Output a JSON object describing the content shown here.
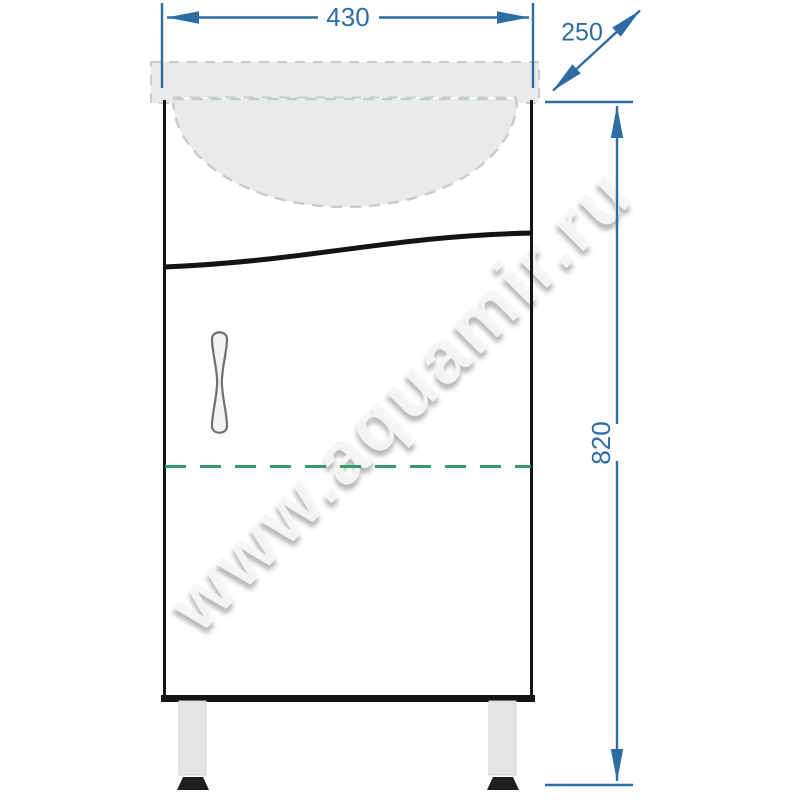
{
  "diagram": {
    "type": "furniture-dimension-drawing",
    "subject": "vanity cabinet with washbasin, front view",
    "watermark": "www.aquamir.ru",
    "dimensions": {
      "width": {
        "value": "430"
      },
      "depth": {
        "value": "250"
      },
      "height": {
        "value": "820"
      }
    },
    "colors": {
      "dimension_line": "#2e6da4",
      "hidden_divider": "#2f9e68",
      "sink_fill": "#e9ebeb",
      "sink_outline": "#c6cbcb",
      "cabinet_outline": "#141414",
      "leg_fill": "#e4e5e5",
      "leg_edge": "#d2d4d4",
      "foot_fill": "#1e1e1e",
      "handle_outline": "#6f6f6f",
      "handle_fill": "#f3f3f3",
      "background": "#ffffff"
    }
  }
}
